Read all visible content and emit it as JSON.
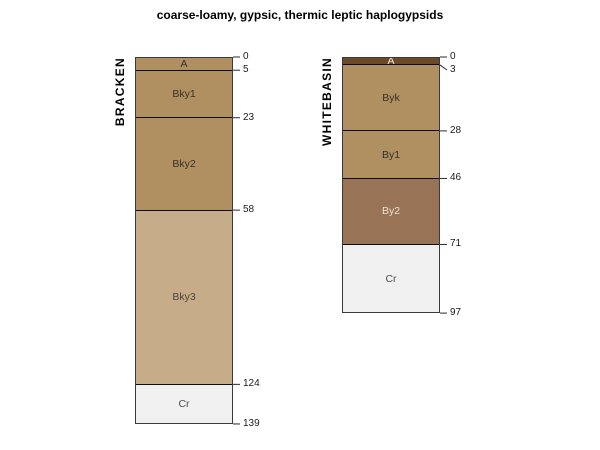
{
  "title": "coarse-loamy, gypsic, thermic leptic haplogypsids",
  "chart_data": {
    "type": "bar",
    "subtype": "soil-profile-depth-diagram",
    "title": "coarse-loamy, gypsic, thermic leptic haplogypsids",
    "depth_direction": "down",
    "profiles": [
      {
        "name": "BRACKEN",
        "max_depth": 139,
        "depth_ticks": [
          0,
          5,
          23,
          58,
          124,
          139
        ],
        "horizons": [
          {
            "label": "A",
            "top": 0,
            "bottom": 5,
            "color": "#b08f61",
            "label_color": "#36312a"
          },
          {
            "label": "Bky1",
            "top": 5,
            "bottom": 23,
            "color": "#b08f61",
            "label_color": "#36312a"
          },
          {
            "label": "Bky2",
            "top": 23,
            "bottom": 58,
            "color": "#b08f61",
            "label_color": "#36312a"
          },
          {
            "label": "Bky3",
            "top": 58,
            "bottom": 124,
            "color": "#c7ac8a",
            "label_color": "#4a443a"
          },
          {
            "label": "Cr",
            "top": 124,
            "bottom": 139,
            "color": "#f0f0f0",
            "label_color": "#4f4f4f"
          }
        ]
      },
      {
        "name": "WHITEBASIN",
        "max_depth": 97,
        "depth_ticks": [
          0,
          3,
          28,
          46,
          71,
          97
        ],
        "horizons": [
          {
            "label": "A",
            "top": 0,
            "bottom": 3,
            "color": "#6b4a2a",
            "label_color": "#f3ece2"
          },
          {
            "label": "Byk",
            "top": 3,
            "bottom": 28,
            "color": "#b08f61",
            "label_color": "#36312a"
          },
          {
            "label": "By1",
            "top": 28,
            "bottom": 46,
            "color": "#b08f61",
            "label_color": "#36312a"
          },
          {
            "label": "By2",
            "top": 46,
            "bottom": 71,
            "color": "#997355",
            "label_color": "#e9e0d4"
          },
          {
            "label": "Cr",
            "top": 71,
            "bottom": 97,
            "color": "#f0f0f0",
            "label_color": "#4f4f4f"
          }
        ]
      }
    ]
  }
}
